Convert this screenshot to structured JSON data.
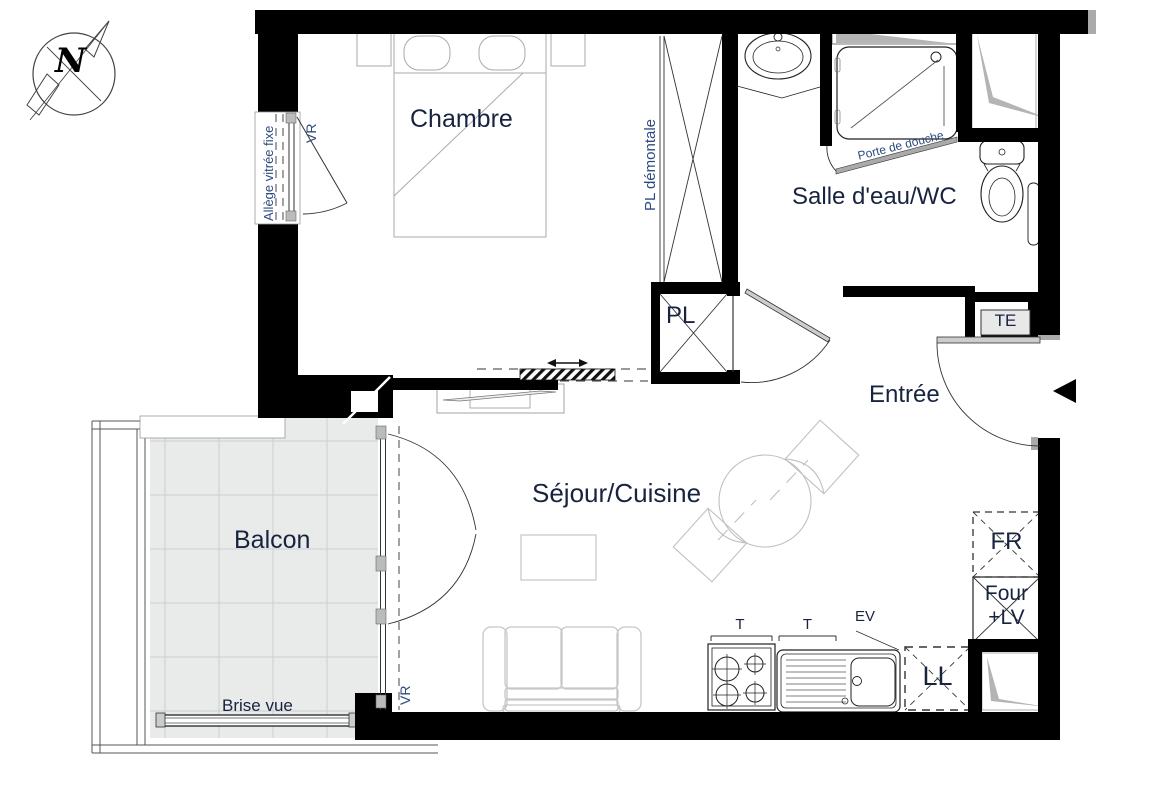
{
  "plan_type": "apartment-floor-plan",
  "labels": {
    "compass_n": "N",
    "rooms": {
      "chambre": "Chambre",
      "salle_eau": "Salle d'eau/WC",
      "entree": "Entrée",
      "sejour": "Séjour/Cuisine",
      "balcon": "Balcon"
    },
    "annotations": {
      "allege": "Allège vitrée fixe",
      "vr_window": "VR",
      "vr_balcony": "VR",
      "pl_demontale": "PL démontale",
      "pl": "PL",
      "porte_douche": "Porte de douche",
      "te": "TE",
      "brise_vue": "Brise vue",
      "fr": "FR",
      "four_line1": "Four",
      "four_line2": "+LV",
      "ll": "LL",
      "t_stove": "T",
      "t_sink": "T",
      "ev": "EV"
    }
  },
  "colors": {
    "wall": "#000000",
    "room_label": "#17233f",
    "annotation_label": "#2d4b80",
    "balcony_tile": "#e9eaea",
    "duct_gray": "#b4b4b4",
    "furniture_light_gray": "#c6c6c6",
    "hardware_gray": "#bbbbbb"
  }
}
